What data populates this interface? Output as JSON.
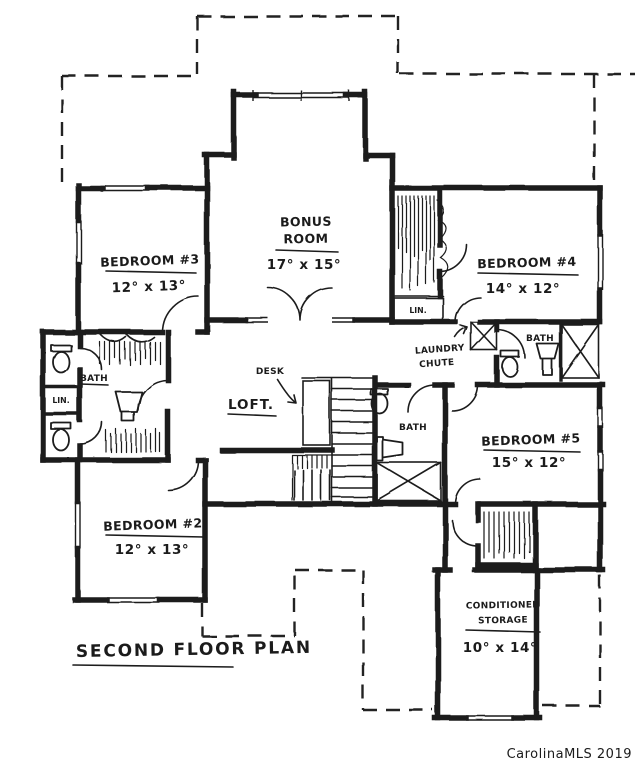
{
  "page": {
    "title": "Second Floor Plan",
    "watermark": "CarolinaMLS 2019",
    "ink_color": "#1c1c1c",
    "watermark_color": "#b9bcbf",
    "paper_color": "#ffffff"
  },
  "rooms": {
    "bedroom3": {
      "name": "Bedroom #3",
      "dimensions": "12° x 13°"
    },
    "bonus_room": {
      "name_line1": "Bonus",
      "name_line2": "Room",
      "dimensions": "17° x 15°"
    },
    "bedroom4": {
      "name": "Bedroom #4",
      "dimensions": "14° x 12°"
    },
    "bedroom5": {
      "name": "Bedroom #5",
      "dimensions": "15° x 12°"
    },
    "bedroom2": {
      "name": "Bedroom #2",
      "dimensions": "12° x 13°"
    },
    "conditioned_storage": {
      "name_line1": "Conditioned",
      "name_line2": "Storage",
      "dimensions": "10° x 14°"
    },
    "loft": {
      "name": "Loft."
    }
  },
  "annotations": {
    "desk": "Desk",
    "laundry_chute_line1": "Laundry",
    "laundry_chute_line2": "chute",
    "bath_jack_and_jill": "Bath",
    "bath_center": "Bath",
    "bath_hall": "Bath",
    "linen_left": "Lin.",
    "linen_hall": "Lin."
  }
}
